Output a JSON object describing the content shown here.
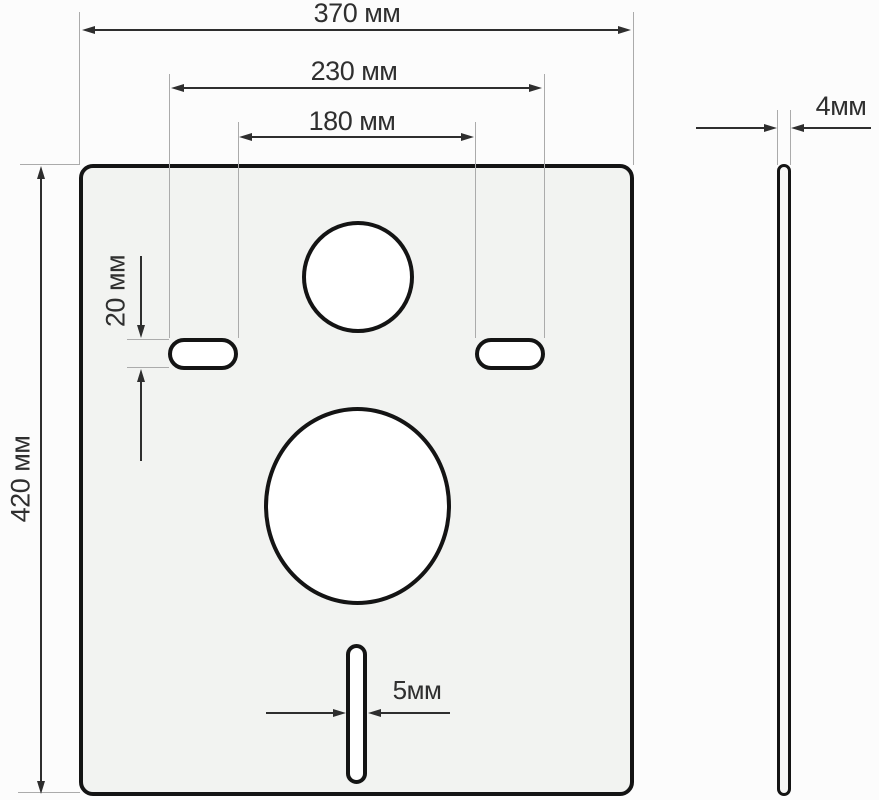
{
  "dimensions": {
    "plate_width": {
      "label": "370 мм",
      "value": 370,
      "unit": "мм"
    },
    "slots_outer_span": {
      "label": "230 мм",
      "value": 230,
      "unit": "мм"
    },
    "slots_inner_span": {
      "label": "180 мм",
      "value": 180,
      "unit": "мм"
    },
    "plate_height": {
      "label": "420 мм",
      "value": 420,
      "unit": "мм"
    },
    "mount_slot_height": {
      "label": "20 мм",
      "value": 20,
      "unit": "мм"
    },
    "bottom_slot_width": {
      "label": "5мм",
      "value": 5,
      "unit": "мм"
    },
    "plate_thickness": {
      "label": "4мм",
      "value": 4,
      "unit": "мм"
    }
  },
  "colors": {
    "background": "#fcfcfc",
    "plate_fill": "#f2f3f1",
    "hole_fill": "#ffffff",
    "outline": "#141414",
    "dimension_line": "#2e2e2e",
    "extension_line": "#ababab",
    "text": "#2f2f2f"
  }
}
